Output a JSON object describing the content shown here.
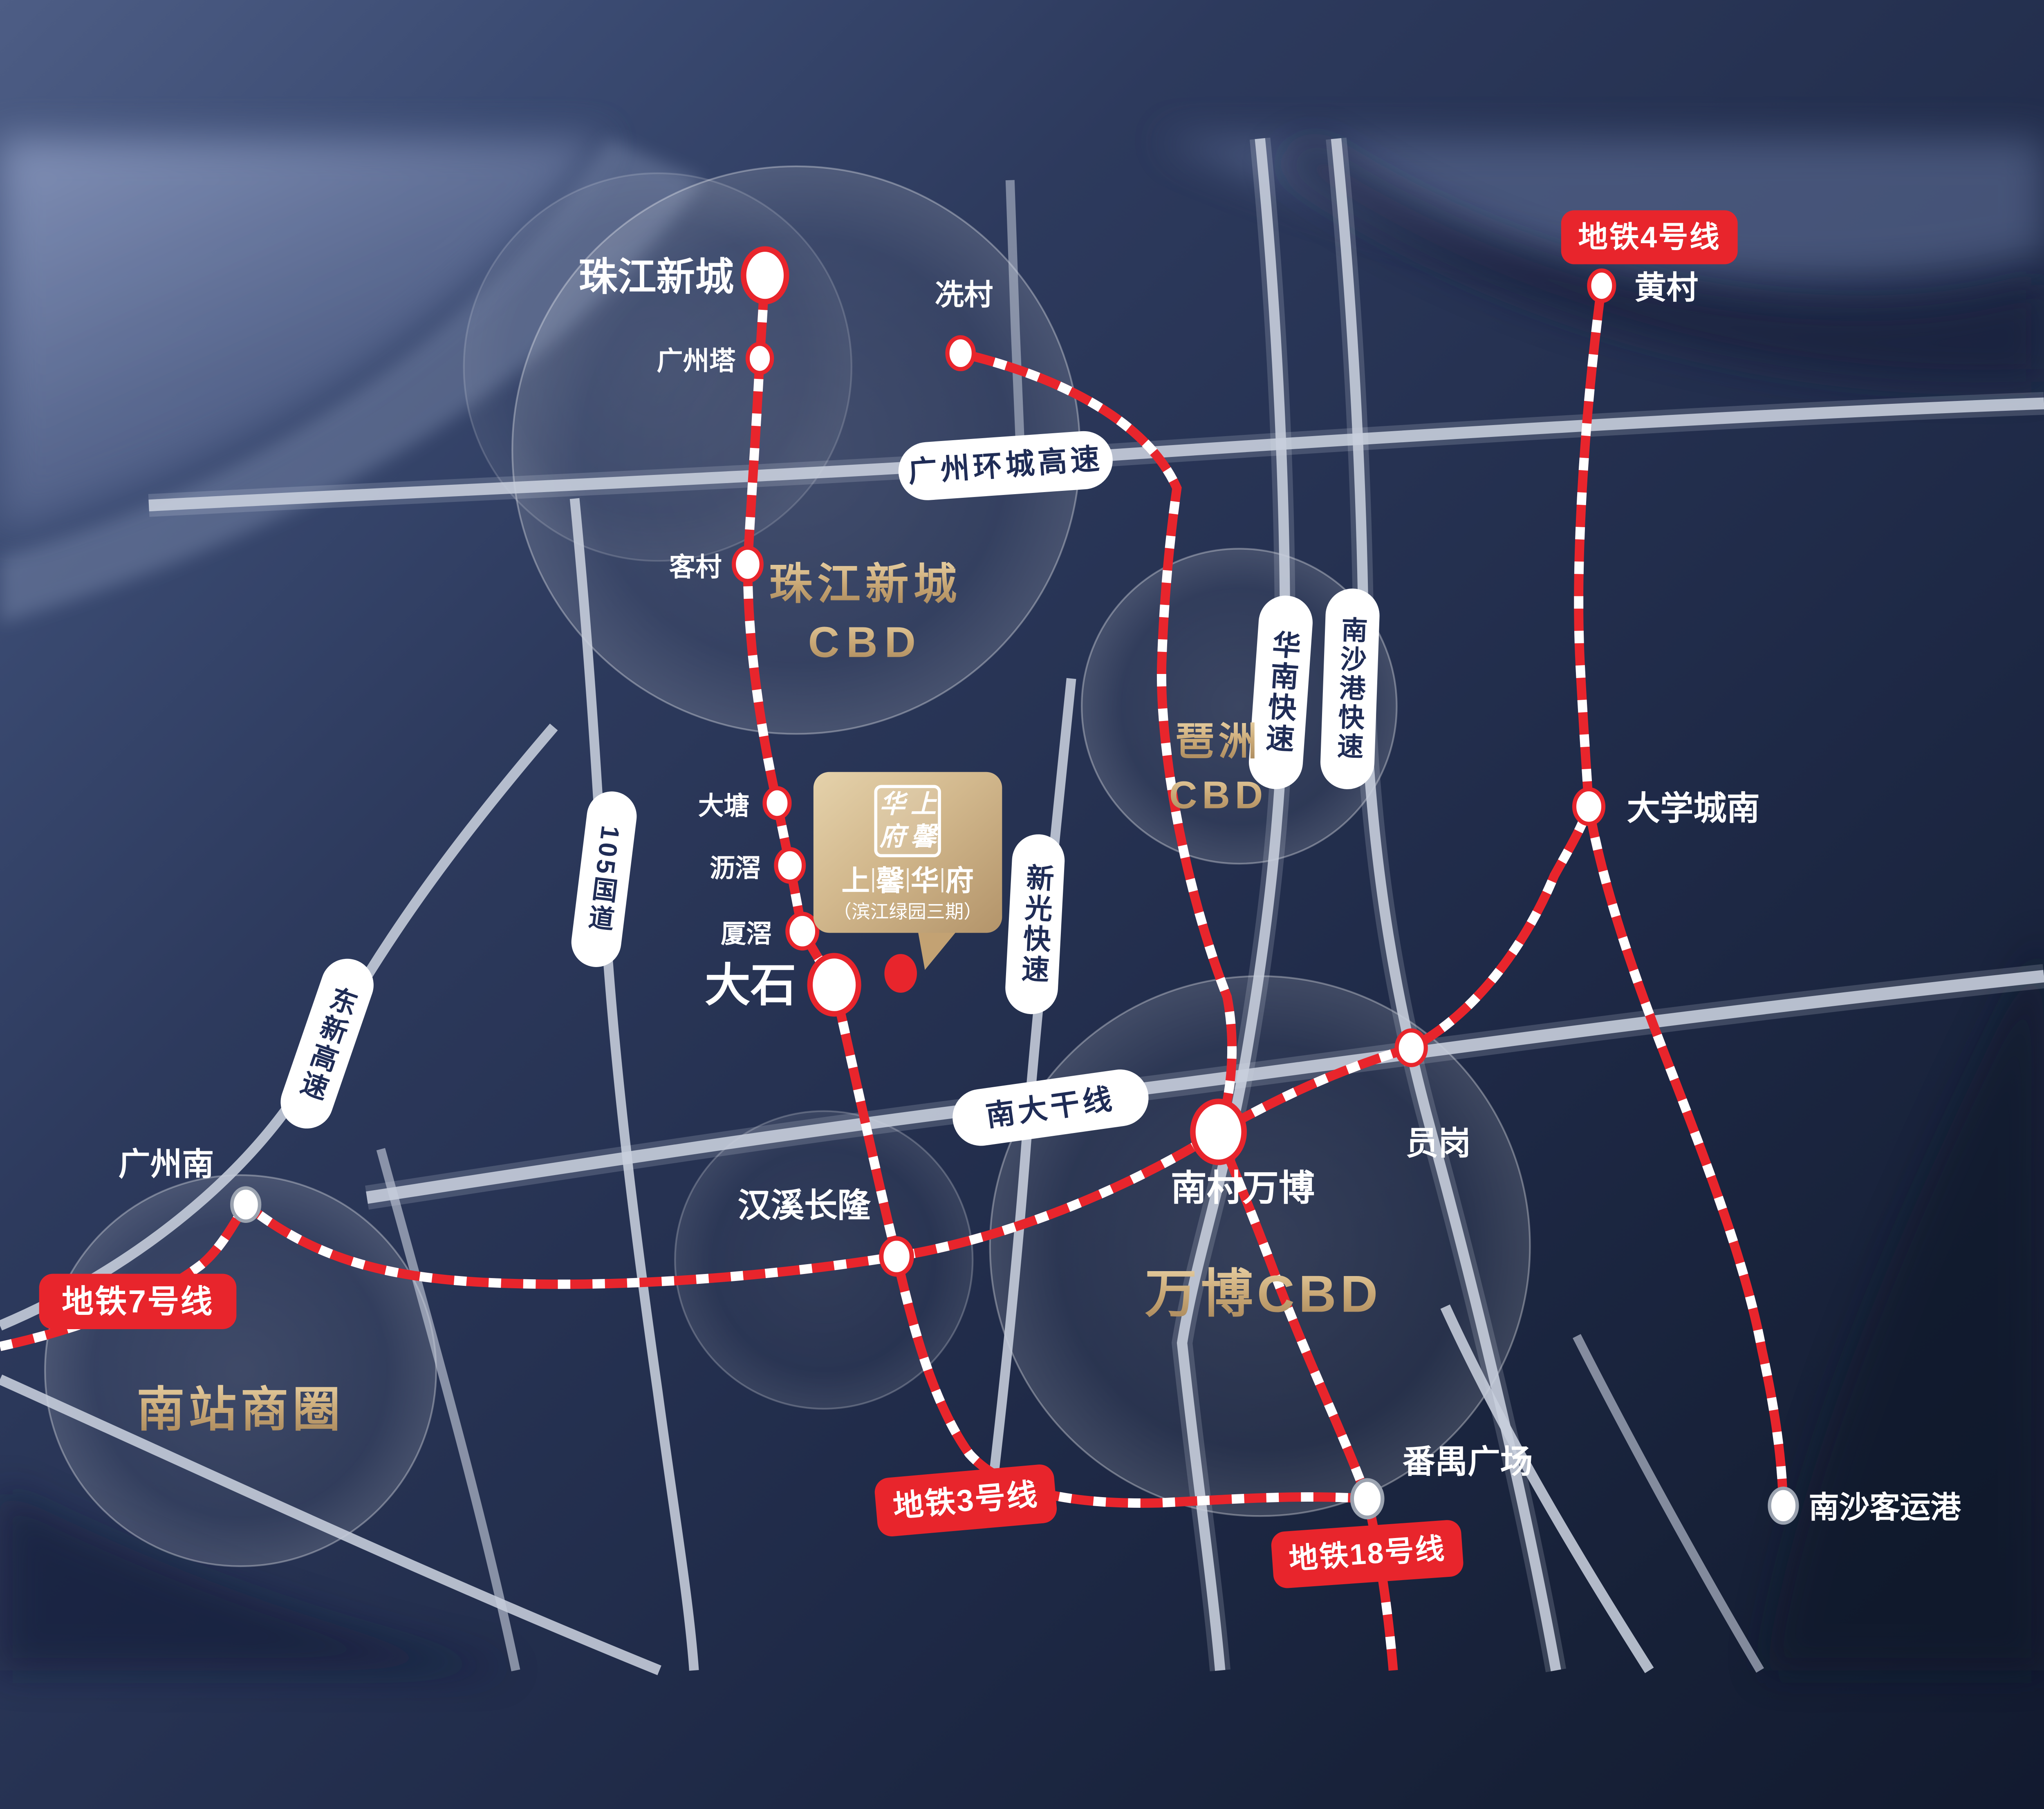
{
  "poster": {
    "project": {
      "logo_chars": [
        "上",
        "馨",
        "华",
        "府"
      ],
      "name_chars": [
        "上",
        "馨",
        "华",
        "府"
      ],
      "subtitle": "（滨江绿园三期）"
    },
    "cbd_areas": {
      "zhujiang": {
        "line1": "珠江新城",
        "line2": "CBD"
      },
      "pazhou": {
        "line1": "琶洲",
        "line2": "CBD"
      },
      "wanbo": {
        "line1": "万博CBD"
      },
      "nanzhan": {
        "line1": "南站商圈"
      }
    },
    "metro_badges": {
      "line3": "地铁3号线",
      "line4": "地铁4号线",
      "line7": "地铁7号线",
      "line18": "地铁18号线"
    },
    "stations": [
      {
        "id": "zhujiang-xincheng",
        "label": "珠江新城"
      },
      {
        "id": "guangzhou-ta",
        "label": "广州塔"
      },
      {
        "id": "xiancun",
        "label": "冼村"
      },
      {
        "id": "kecun",
        "label": "客村"
      },
      {
        "id": "datang",
        "label": "大塘"
      },
      {
        "id": "lijiao",
        "label": "沥滘"
      },
      {
        "id": "xiajiao",
        "label": "厦滘"
      },
      {
        "id": "dashi",
        "label": "大石"
      },
      {
        "id": "hanxi-changlong",
        "label": "汉溪长隆"
      },
      {
        "id": "nancun-wanbo",
        "label": "南村万博"
      },
      {
        "id": "yuangang",
        "label": "员岗"
      },
      {
        "id": "daxuecheng-nan",
        "label": "大学城南"
      },
      {
        "id": "huangcun",
        "label": "黄村"
      },
      {
        "id": "guangzhou-nan",
        "label": "广州南"
      },
      {
        "id": "panyu-guangchang",
        "label": "番禺广场"
      },
      {
        "id": "nansha-keyungang",
        "label": "南沙客运港"
      }
    ],
    "roads": [
      {
        "id": "huancheng",
        "label": "广州环城高速"
      },
      {
        "id": "huanan",
        "label": "华南快速"
      },
      {
        "id": "nanshagang",
        "label": "南沙港快速"
      },
      {
        "id": "guodao105",
        "label": "105国道"
      },
      {
        "id": "dongxin",
        "label": "东新高速"
      },
      {
        "id": "xinguang",
        "label": "新光快速"
      },
      {
        "id": "nanda",
        "label": "南大干线"
      }
    ],
    "colors": {
      "metro_red": "#e8252c",
      "road_label_navy": "#1f2c56",
      "gold": "#c9a876",
      "background_navy": "#1e2946"
    }
  }
}
